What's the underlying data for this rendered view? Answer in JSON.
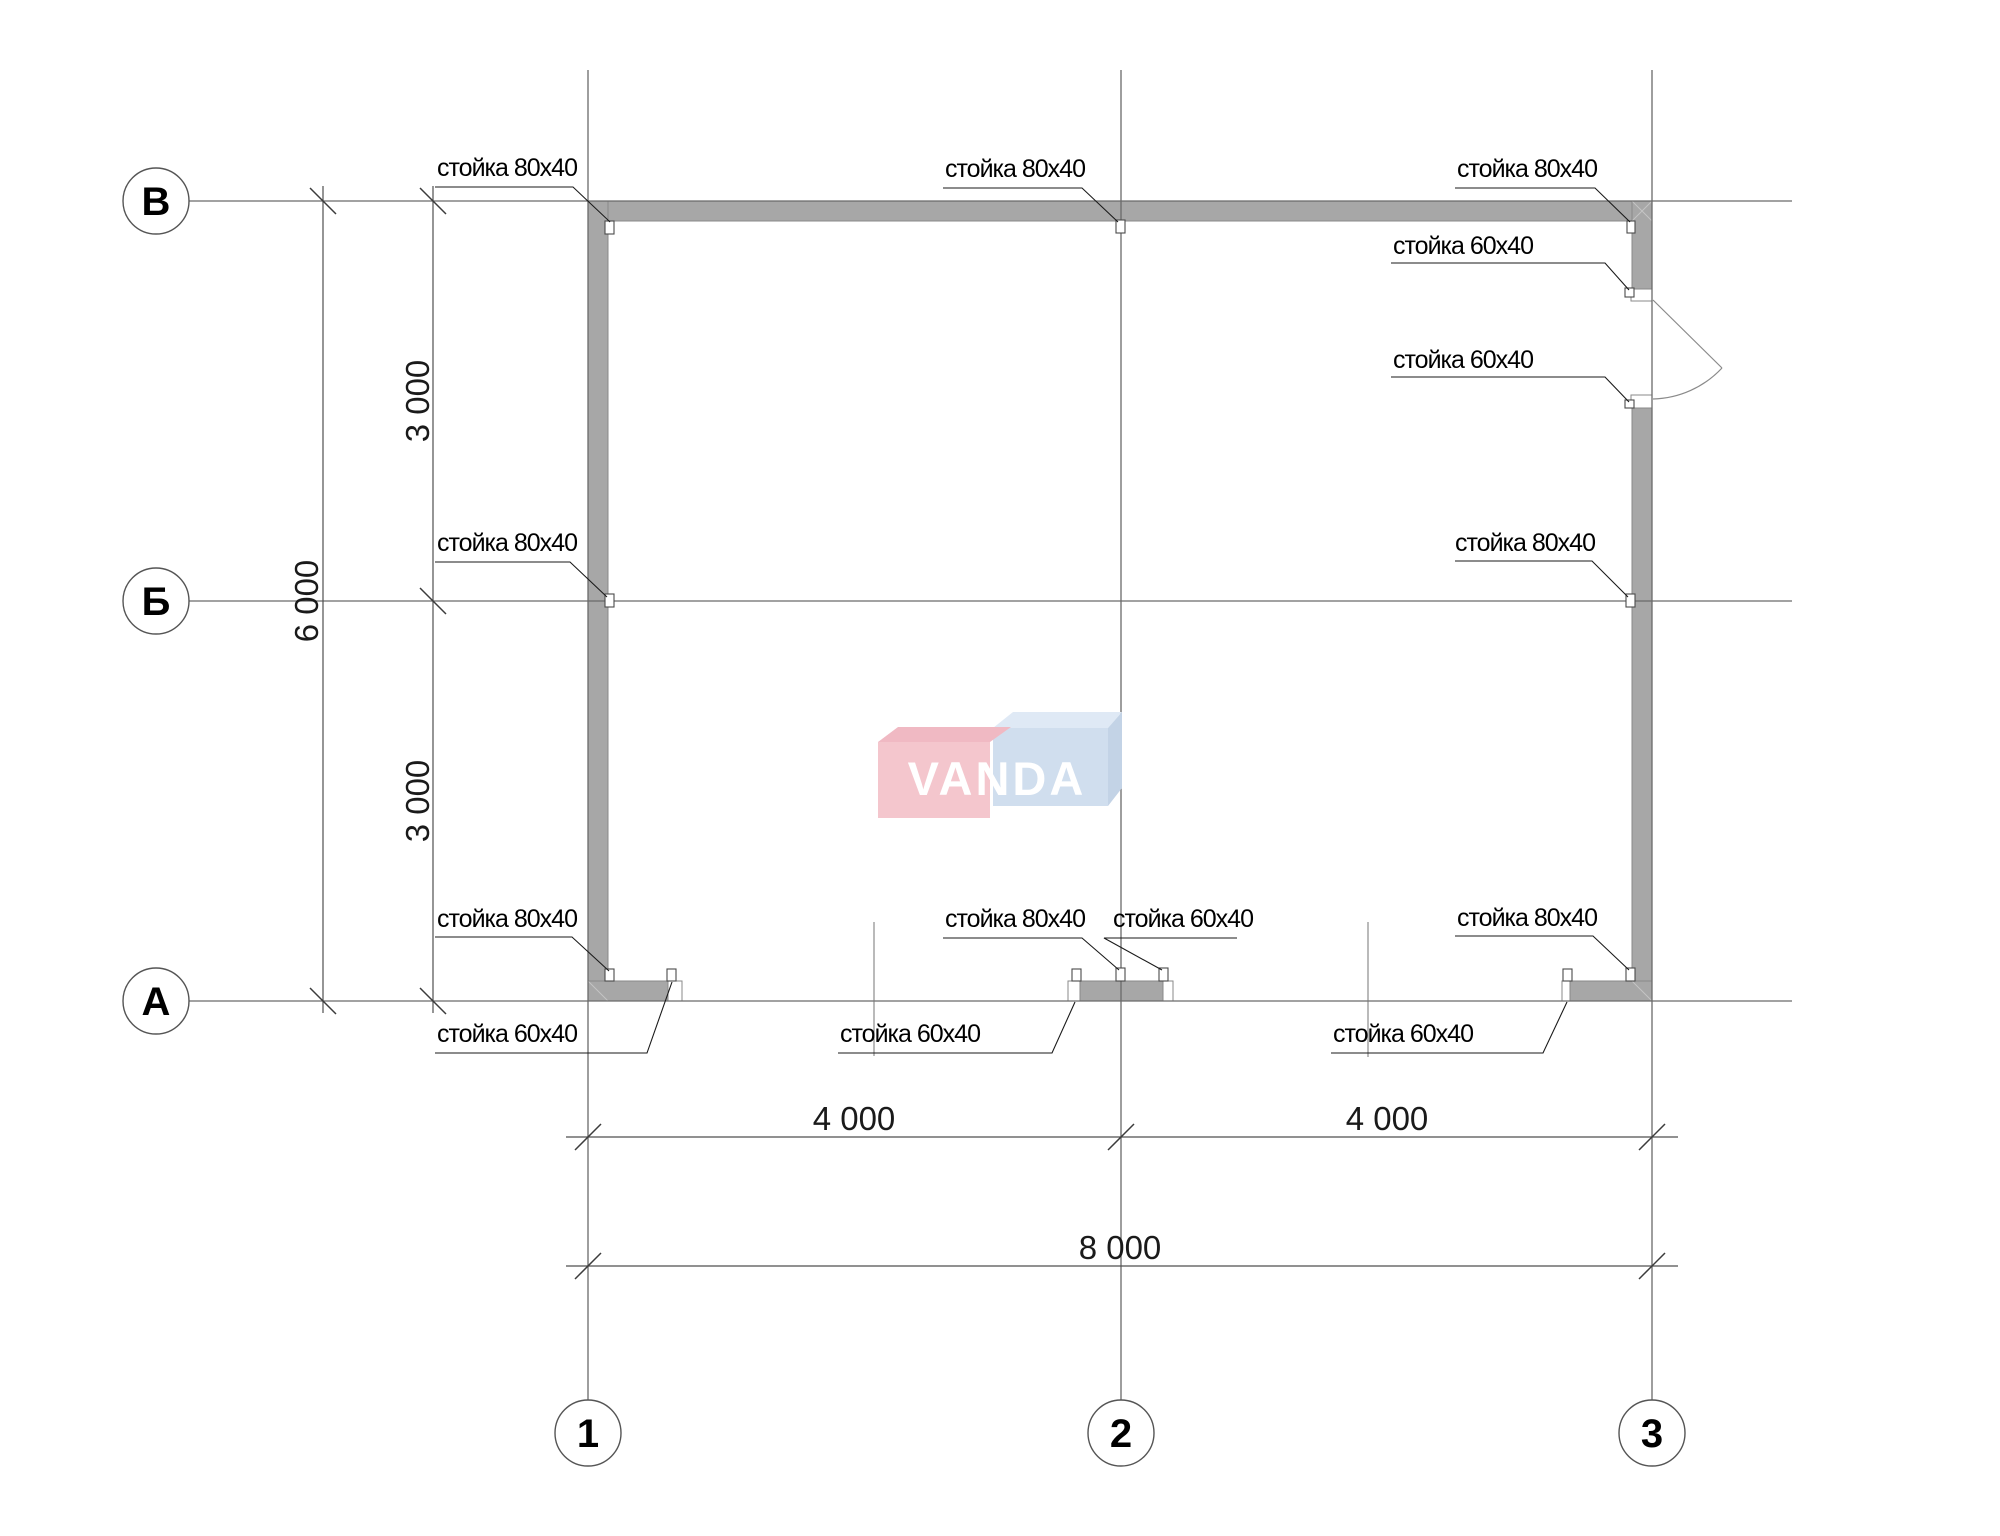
{
  "drawing": {
    "axes": {
      "rows": [
        {
          "label": "В"
        },
        {
          "label": "Б"
        },
        {
          "label": "А"
        }
      ],
      "cols": [
        {
          "label": "1"
        },
        {
          "label": "2"
        },
        {
          "label": "3"
        }
      ]
    },
    "dimensions": {
      "row_segment_top": "3 000",
      "row_segment_bottom": "3 000",
      "row_total": "6 000",
      "col_segment_left": "4 000",
      "col_segment_right": "4 000",
      "col_total": "8 000"
    },
    "annotations": {
      "post_80": "стойка 80х40",
      "post_60": "стойка 60х40"
    },
    "watermark": "VANDA",
    "colors": {
      "wall_fill": "#a7a7a7",
      "wall_edge": "#8a8a8a",
      "line": "#6a6a6a",
      "logo_pink_front": "#f4c6cd",
      "logo_pink_top": "#f0b9c3",
      "logo_blue_front": "#d0deee",
      "logo_blue_top": "#dfe9f5",
      "logo_blue_side": "#c3d3e6",
      "logo_text": "#ffffff"
    }
  }
}
